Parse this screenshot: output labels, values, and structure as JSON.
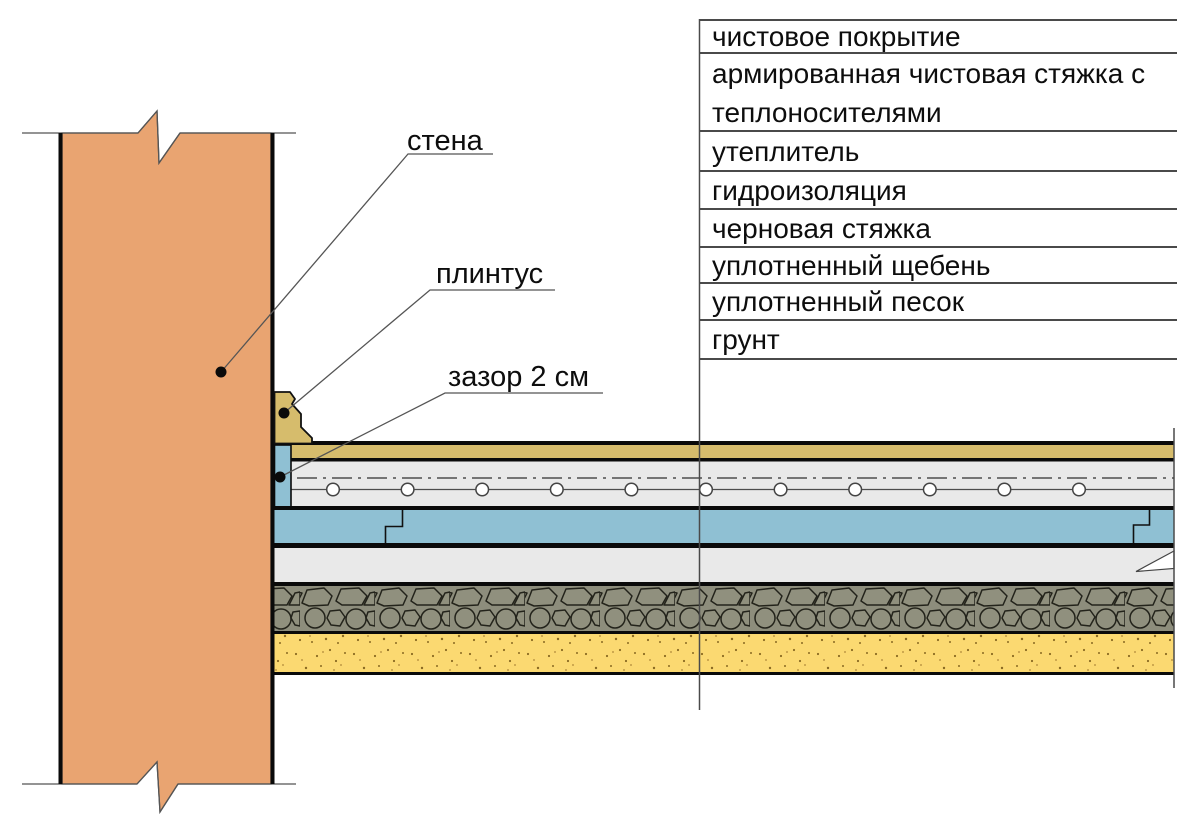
{
  "title": "floor layers construction section",
  "legend": {
    "items": [
      "чистовое покрытие",
      "армированная чистовая стяжка с теплоносителями",
      "утеплитель",
      "гидроизоляция",
      "черновая стяжка",
      "уплотненный щебень",
      "уплотненный песок",
      "грунт"
    ]
  },
  "callouts": {
    "wall": "стена",
    "plinth": "плинтус",
    "gap": "зазор 2 см"
  },
  "colors": {
    "wall": "#E9A471",
    "plinth_and_finish": "#D6BC6C",
    "insulation_blue": "#8FC0D3",
    "screed_gray": "#E9E9E9",
    "gravel_olive": "#8D8D7C",
    "sand_yellow": "#FBD971",
    "line_dark": "#0A0A0A",
    "line_thin": "#4A4A4A"
  }
}
